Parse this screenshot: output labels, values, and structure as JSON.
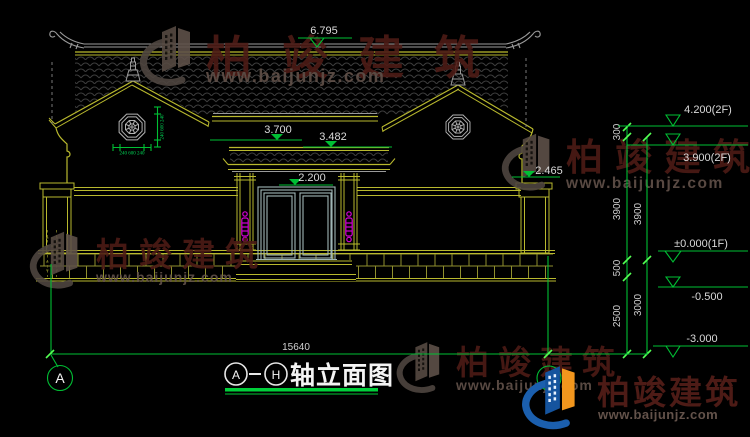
{
  "drawing": {
    "title": {
      "axis_from": "A",
      "axis_to": "H",
      "name": "轴立面图"
    },
    "axis_bubble_label": "A",
    "levels": {
      "ridge": "6.795",
      "main_eave": "3.700",
      "porch_top": "3.482",
      "door_top": "2.200",
      "side_eave": "2.465",
      "roof2": "4.200(2F)",
      "floor2": "3.900(2F)",
      "floor1": "±0.000(1F)",
      "grade": "-0.500",
      "foundation": "-3.000"
    },
    "dims": {
      "parapet": "300",
      "floor_height_a": "3900",
      "floor_height_b": "3900",
      "plinth": "500",
      "below_grade": "2500",
      "foundation_depth": "3000",
      "total_width": "15640",
      "octagon_h": "240 600 240",
      "octagon_v": "240 600 240"
    }
  },
  "watermark": {
    "brand": "柏竣建筑",
    "site": "www.baijunjz.com"
  },
  "colors": {
    "dim_green": "#00bf34",
    "cad_yellow": "#b9b92e",
    "lamp_magenta": "#d400d4",
    "brand_blue": "#1b5fae",
    "brand_orange": "#f2961d",
    "brand_red": "#571111"
  }
}
